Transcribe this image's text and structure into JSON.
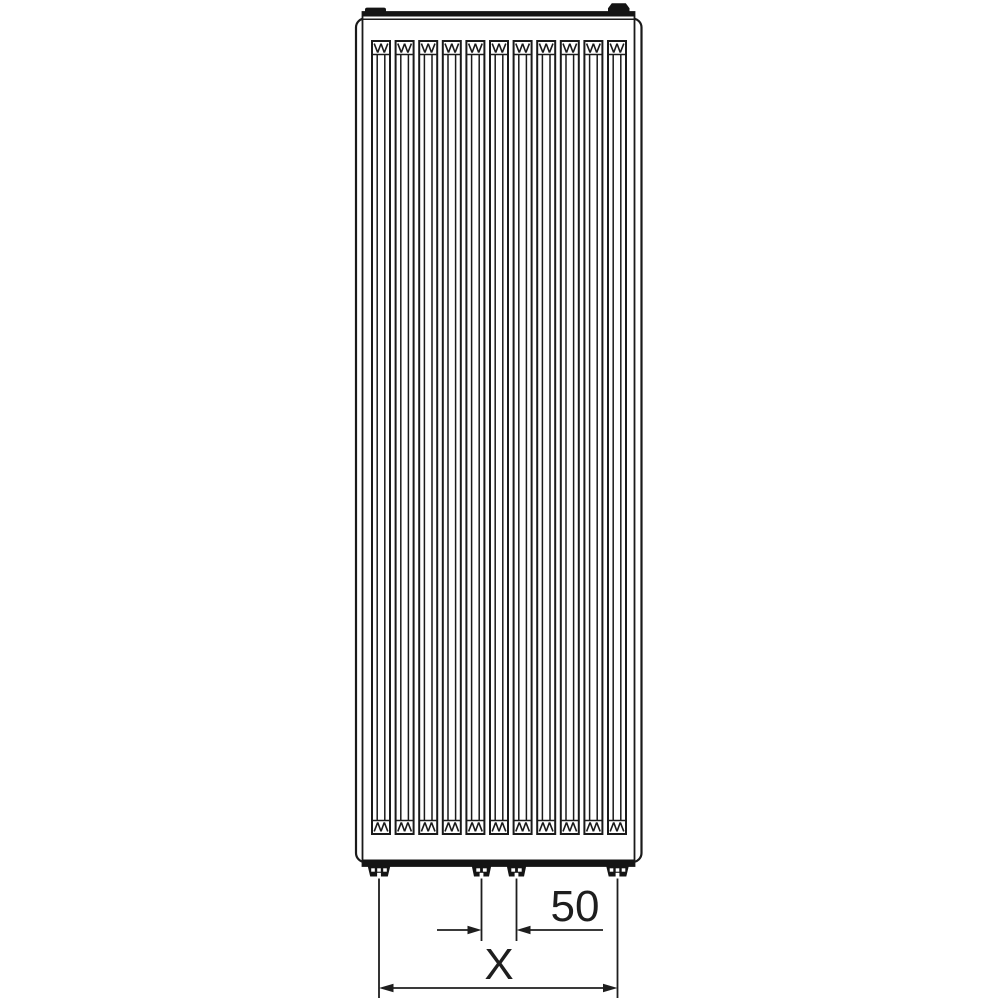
{
  "page": {
    "background": "#ffffff"
  },
  "drawing": {
    "subject": "Vertical panel radiator, front view technical drawing",
    "line_color": "#1a1a1a",
    "fill_color": "#141414",
    "fin_count": 11,
    "dimensions": {
      "connection_spacing": {
        "label": "50"
      },
      "overall_width": {
        "label": "X"
      }
    }
  }
}
